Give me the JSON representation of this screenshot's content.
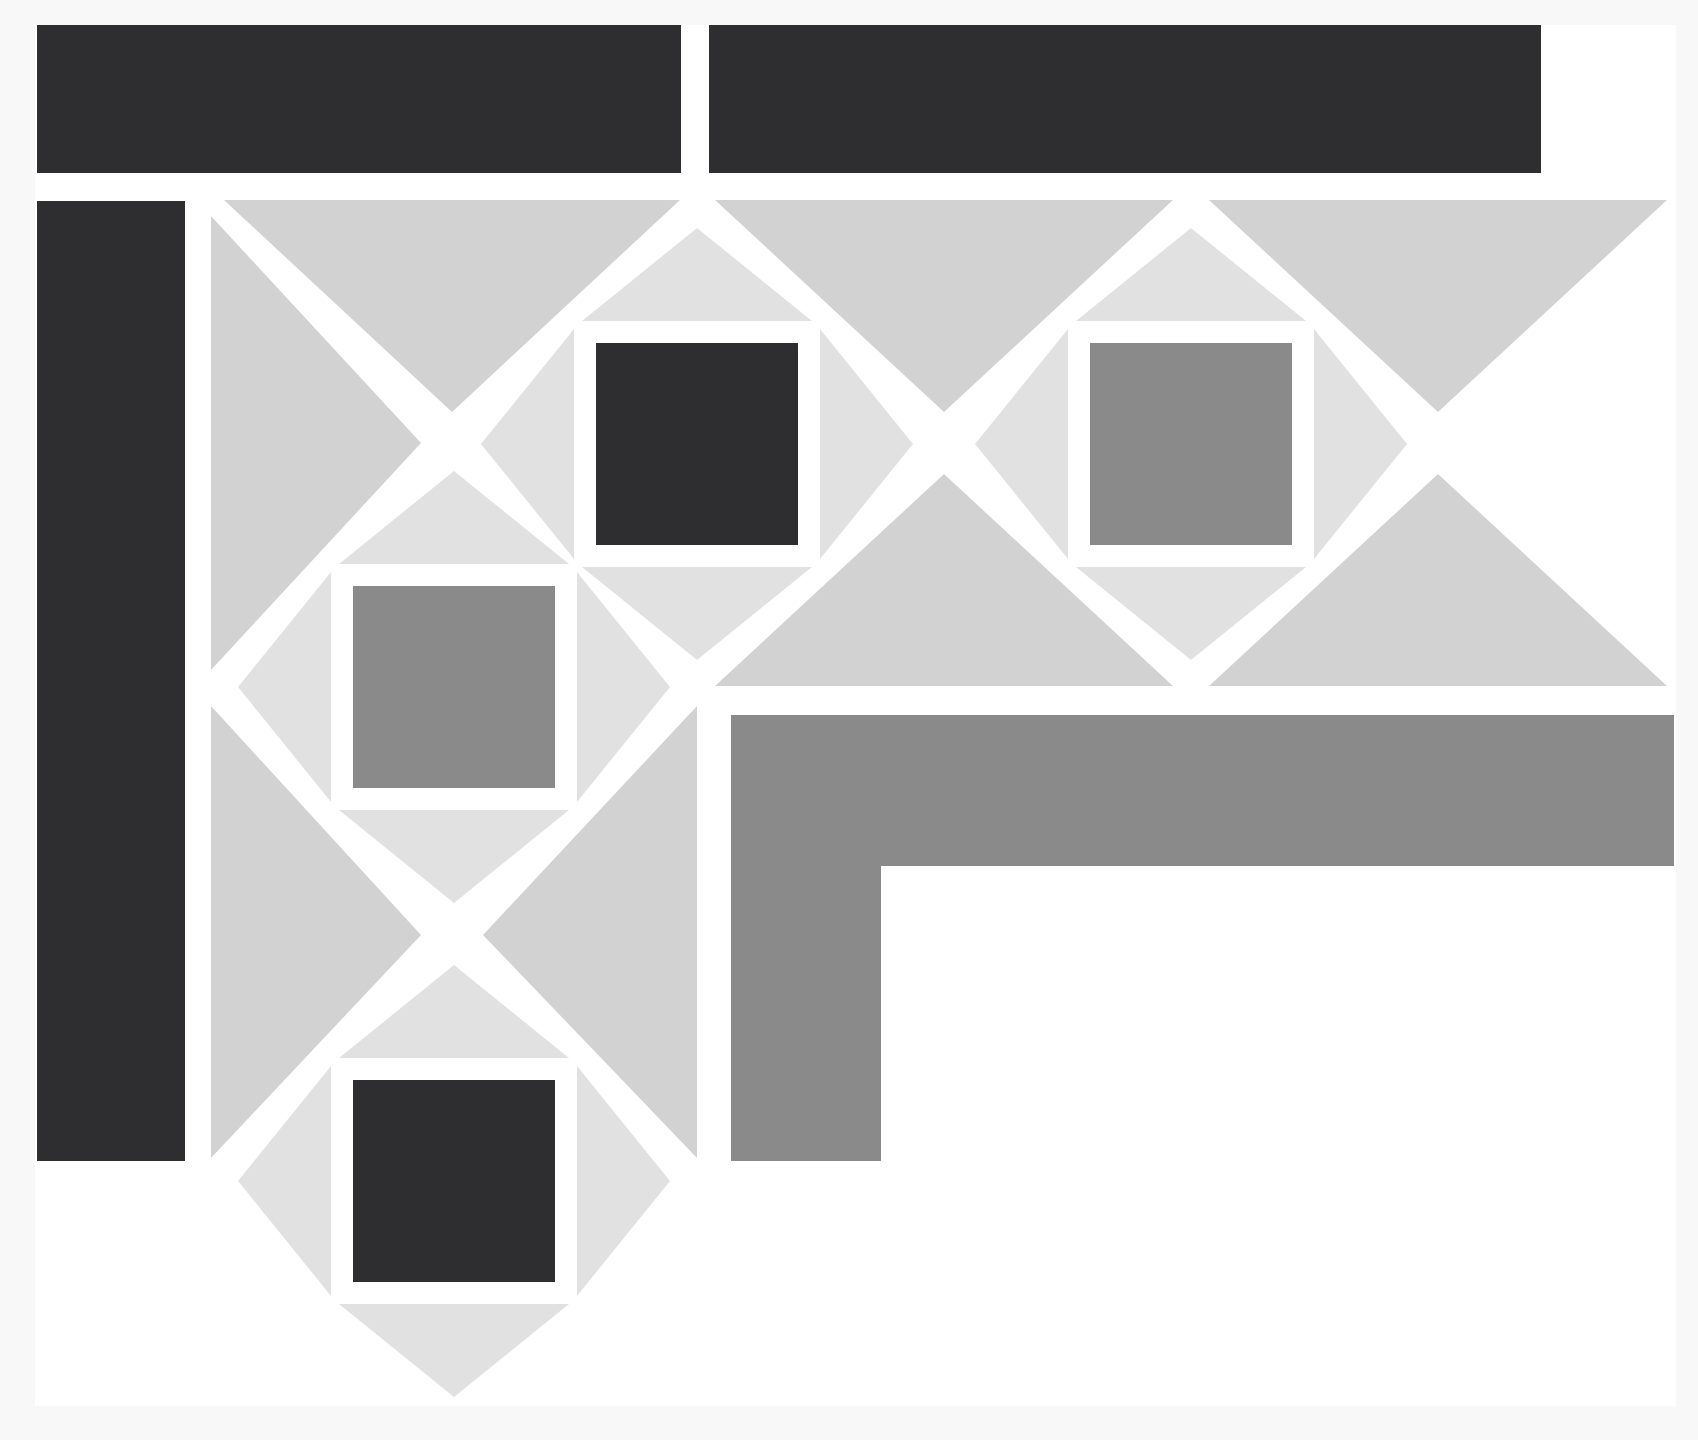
{
  "title": "quilt-border-corner-pattern",
  "canvas": {
    "width": 1698,
    "height": 1440
  },
  "palette": {
    "page_background": "#f8f8f9",
    "content_background": "#ffffff",
    "dark": "#2e2e30",
    "medium_gray": "#8a8a8a",
    "triangle_large": "#d2d2d2",
    "triangle_small": "#e1e1e1"
  },
  "content_area": {
    "x": 35,
    "y": 25,
    "width": 1641,
    "height": 1381
  },
  "bars": [
    {
      "name": "binding-bar-top-left",
      "x": 37,
      "y": 25,
      "width": 644,
      "height": 148,
      "fill": "dark"
    },
    {
      "name": "binding-bar-top-right",
      "x": 709,
      "y": 25,
      "width": 832,
      "height": 148,
      "fill": "dark"
    },
    {
      "name": "binding-bar-left",
      "x": 37,
      "y": 201,
      "width": 148,
      "height": 960,
      "fill": "dark"
    }
  ],
  "l_bar": {
    "name": "inner-border-l-bar",
    "points": "731,715 1674,715 1674,866 881,866 881,1161 731,1161",
    "fill": "medium_gray"
  },
  "setting_triangles": [
    {
      "name": "setting-triangle-top-corner",
      "points": "224,200 680,200 452,412",
      "fill": "triangle_large"
    },
    {
      "name": "setting-triangle-top-middle",
      "points": "715,200 1173,200 944,412",
      "fill": "triangle_large"
    },
    {
      "name": "setting-triangle-top-right",
      "points": "1209,200 1667,200 1438,412",
      "fill": "triangle_large"
    },
    {
      "name": "setting-triangle-bottom-middle",
      "points": "715,686 1173,686 944,474",
      "fill": "triangle_large"
    },
    {
      "name": "setting-triangle-bottom-right",
      "points": "1209,686 1667,686 1438,474",
      "fill": "triangle_large"
    },
    {
      "name": "setting-triangle-left-corner",
      "points": "211,216 211,670 421,443",
      "fill": "triangle_large"
    },
    {
      "name": "setting-triangle-left-lower",
      "points": "211,706 211,1158 421,935",
      "fill": "triangle_large"
    },
    {
      "name": "setting-triangle-right-lower",
      "points": "697,706 697,1158 483,935",
      "fill": "triangle_large"
    }
  ],
  "inner_triangles": [
    {
      "name": "inner-triangle-d1-top",
      "points": "582,321 812,321 697,228",
      "fill": "triangle_small"
    },
    {
      "name": "inner-triangle-d1-bottom",
      "points": "582,567 812,567 697,660",
      "fill": "triangle_small"
    },
    {
      "name": "inner-triangle-d1-left",
      "points": "574,329 574,559 481,444",
      "fill": "triangle_small"
    },
    {
      "name": "inner-triangle-d1-right",
      "points": "820,329 820,559 913,444",
      "fill": "triangle_small"
    },
    {
      "name": "inner-triangle-d2-top",
      "points": "1076,321 1306,321 1191,228",
      "fill": "triangle_small"
    },
    {
      "name": "inner-triangle-d2-bottom",
      "points": "1076,567 1306,567 1191,660",
      "fill": "triangle_small"
    },
    {
      "name": "inner-triangle-d2-left",
      "points": "1068,329 1068,559 975,444",
      "fill": "triangle_small"
    },
    {
      "name": "inner-triangle-d2-right",
      "points": "1314,329 1314,559 1407,444",
      "fill": "triangle_small"
    },
    {
      "name": "inner-triangle-s3-top",
      "points": "339,564 569,564 454,471",
      "fill": "triangle_small"
    },
    {
      "name": "inner-triangle-s3-bottom",
      "points": "339,810 569,810 454,903",
      "fill": "triangle_small"
    },
    {
      "name": "inner-triangle-s3-left",
      "points": "331,572 331,802 238,687",
      "fill": "triangle_small"
    },
    {
      "name": "inner-triangle-s3-right",
      "points": "577,572 577,802 670,687",
      "fill": "triangle_small"
    },
    {
      "name": "inner-triangle-s4-top",
      "points": "339,1058 569,1058 454,965",
      "fill": "triangle_small"
    },
    {
      "name": "inner-triangle-s4-bottom",
      "points": "339,1304 569,1304 454,1397",
      "fill": "triangle_small"
    },
    {
      "name": "inner-triangle-s4-left",
      "points": "331,1066 331,1296 238,1181",
      "fill": "triangle_small"
    },
    {
      "name": "inner-triangle-s4-right",
      "points": "577,1066 577,1296 670,1181",
      "fill": "triangle_small"
    }
  ],
  "squares": [
    {
      "name": "center-square-top-dark",
      "x": 596,
      "y": 343,
      "width": 202,
      "height": 202,
      "fill": "dark"
    },
    {
      "name": "center-square-top-gray",
      "x": 1090,
      "y": 343,
      "width": 202,
      "height": 202,
      "fill": "medium_gray"
    },
    {
      "name": "center-square-left-gray",
      "x": 353,
      "y": 586,
      "width": 202,
      "height": 202,
      "fill": "medium_gray"
    },
    {
      "name": "center-square-left-dark",
      "x": 353,
      "y": 1080,
      "width": 202,
      "height": 202,
      "fill": "dark"
    }
  ]
}
